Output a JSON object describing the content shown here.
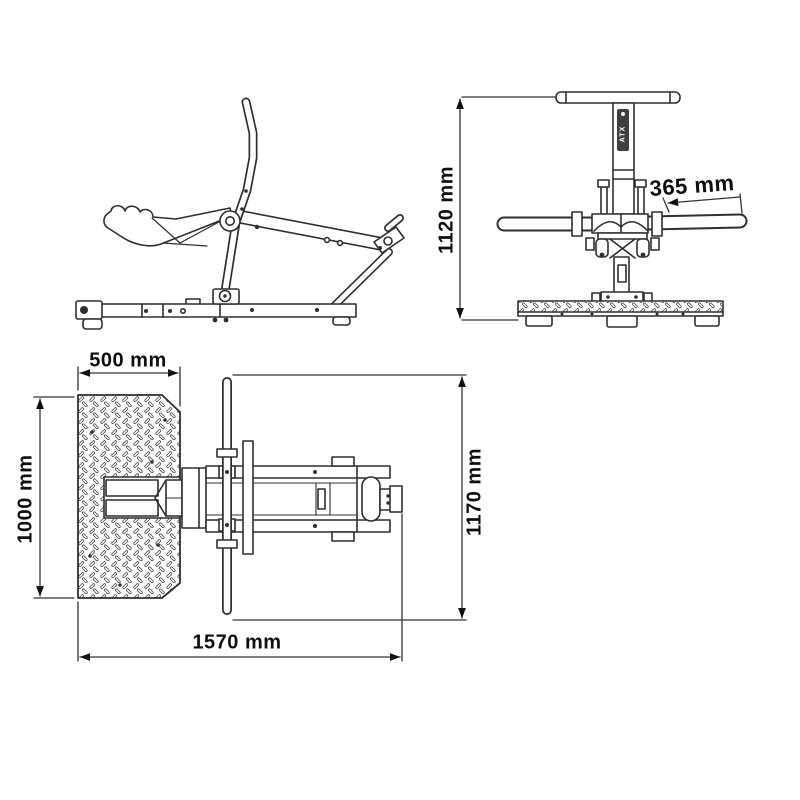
{
  "brand": {
    "badge_text": "ATX"
  },
  "dimensions": {
    "front_height": "1120 mm",
    "handle_grip_length": "365 mm",
    "platform_width": "500 mm",
    "platform_depth": "1000 mm",
    "overall_length": "1570 mm",
    "handlebar_span": "1170 mm"
  },
  "colors": {
    "background": "#ffffff",
    "line": "#2f2f2f",
    "dimension_text": "#0e0e0e",
    "badge_background": "#3f3f3f"
  }
}
